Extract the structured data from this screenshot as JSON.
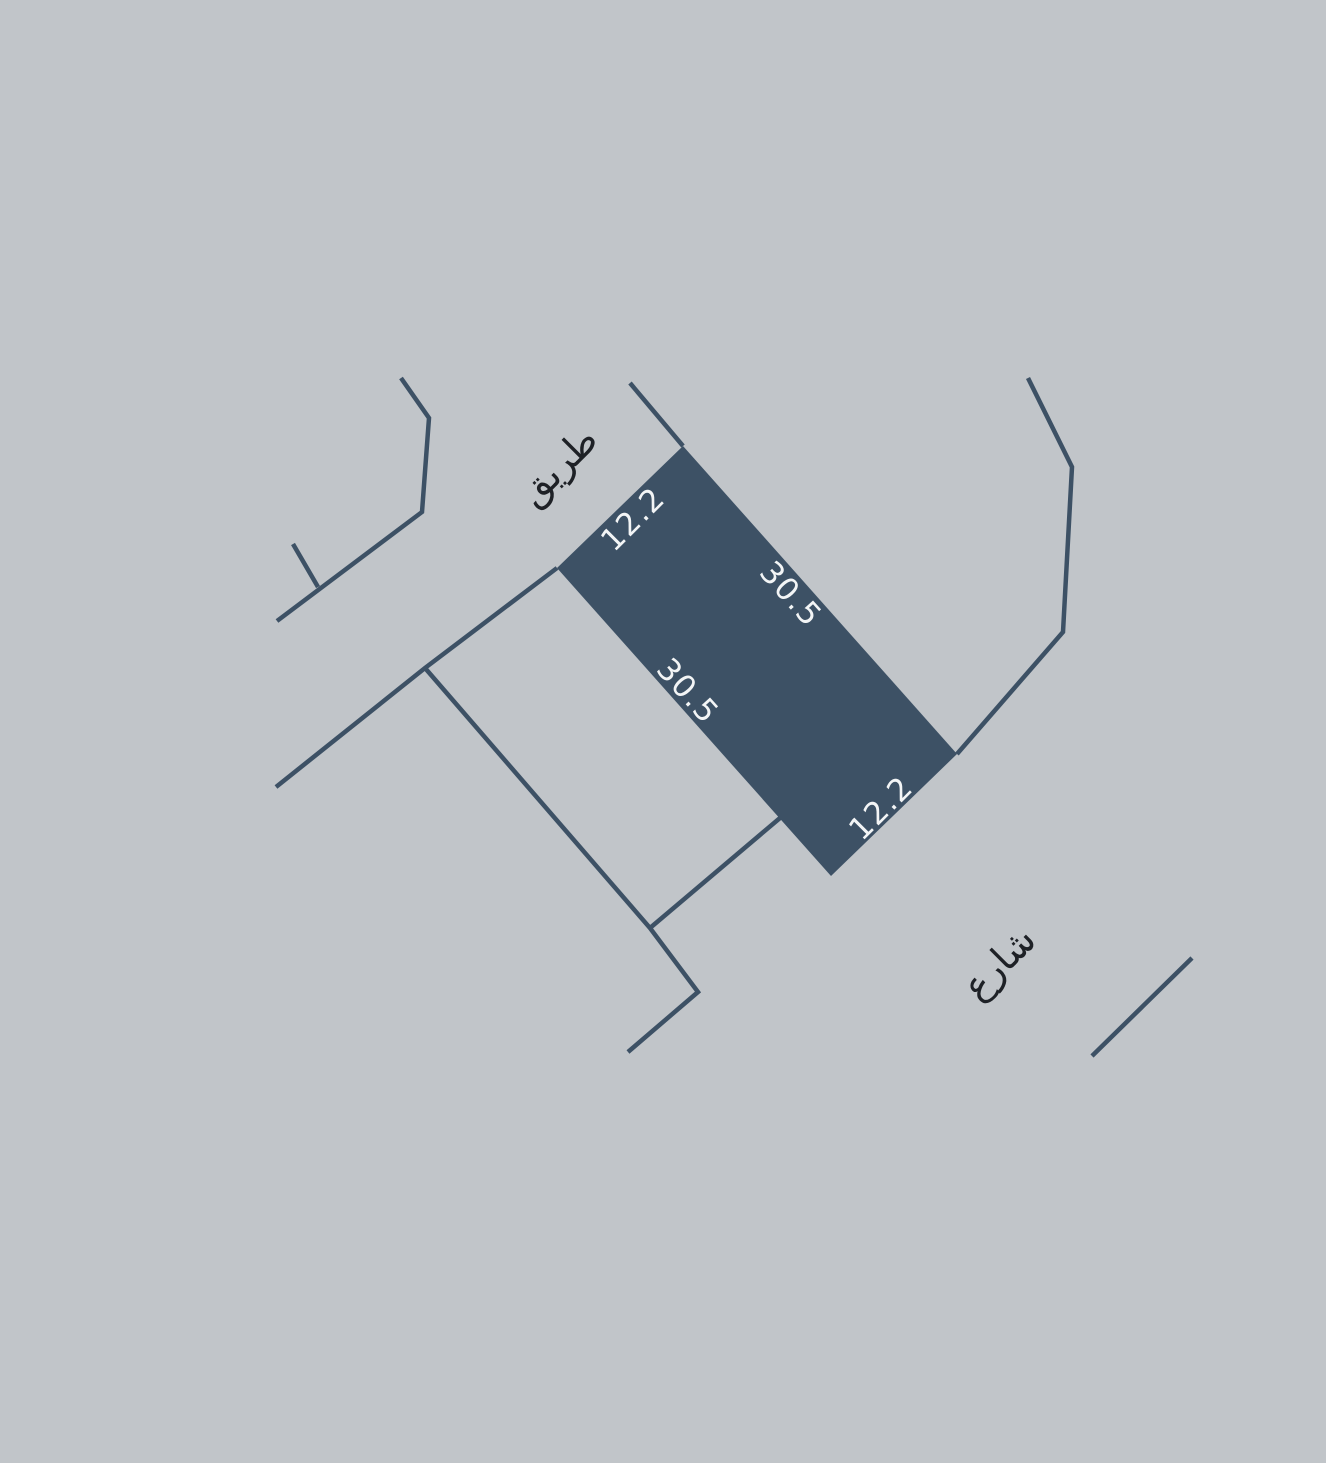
{
  "map": {
    "colors": {
      "background": "#c1c5c9",
      "parcel_fill": "#3d5165",
      "boundary_line": "#3d5165",
      "dimension_text": "#f3f5f6",
      "road_text": "#1e2126"
    },
    "parcel": {
      "dim_top": "12.2",
      "dim_right": "30.5",
      "dim_left": "30.5",
      "dim_bottom": "12.2"
    },
    "roads": {
      "top_label": "طريق",
      "bottom_label": "شارع"
    }
  }
}
